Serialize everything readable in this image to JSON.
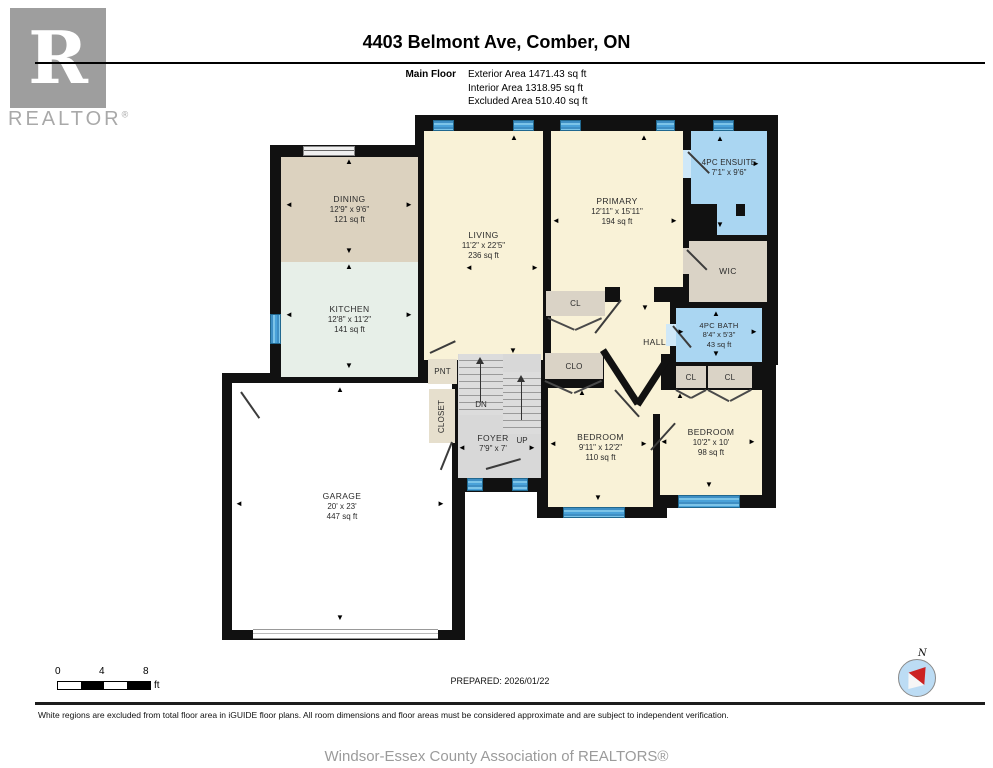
{
  "header": {
    "logo_text": "REALTOR",
    "logo_reg": "®",
    "logo_letter": "R",
    "title": "4403 Belmont Ave, Comber, ON",
    "floor_label": "Main Floor",
    "exterior_area": "Exterior Area 1471.43 sq ft",
    "interior_area": "Interior Area 1318.95 sq ft",
    "excluded_area": "Excluded Area 510.40 sq ft"
  },
  "plan": {
    "rooms": {
      "dining": {
        "name": "DINING",
        "dims": "12'9\" x 9'6\"",
        "area": "121 sq ft"
      },
      "kitchen": {
        "name": "KITCHEN",
        "dims": "12'8\" x 11'2\"",
        "area": "141 sq ft"
      },
      "living": {
        "name": "LIVING",
        "dims": "11'2\" x 22'5\"",
        "area": "236 sq ft"
      },
      "primary": {
        "name": "PRIMARY",
        "dims": "12'11\" x 15'11\"",
        "area": "194 sq ft"
      },
      "ensuite": {
        "name": "4PC ENSUITE",
        "dims": "7'1\" x 9'6\""
      },
      "wic": {
        "name": "WIC"
      },
      "bath": {
        "name": "4PC BATH",
        "dims": "8'4\" x 5'3\"",
        "area": "43 sq ft"
      },
      "hall": {
        "name": "HALL"
      },
      "bedroom1": {
        "name": "BEDROOM",
        "dims": "9'11\" x 12'2\"",
        "area": "110 sq ft"
      },
      "bedroom2": {
        "name": "BEDROOM",
        "dims": "10'2\" x 10'",
        "area": "98 sq ft"
      },
      "garage": {
        "name": "GARAGE",
        "dims": "20' x 23'",
        "area": "447 sq ft"
      },
      "foyer": {
        "name": "FOYER",
        "dims": "7'9\" x 7'"
      },
      "pnt": {
        "name": "PNT"
      },
      "closet": {
        "name": "CLOSET"
      },
      "clo": {
        "name": "CLO"
      },
      "cl": {
        "name": "CL"
      },
      "stairs": {
        "dn": "DN",
        "up": "UP"
      }
    }
  },
  "footer": {
    "scale": {
      "t0": "0",
      "t4": "4",
      "t8": "8",
      "unit": "ft"
    },
    "prepared": "PREPARED: 2026/01/22",
    "compass_n": "N",
    "disclaimer": "White regions are excluded from total floor area in iGUIDE floor plans. All room dimensions and floor areas must be considered approximate and are subject to independent verification.",
    "association": "Windsor-Essex County Association of REALTORS®"
  },
  "colors": {
    "wall": "#111111",
    "room_cream": "#f9f2d7",
    "dining_tan": "#dcd2bf",
    "kitchen_mint": "#e7efe8",
    "bath_blue": "#aad6f2",
    "closet_tan": "#dad3c6",
    "foyer_gray": "#d8d8d8",
    "window_blue": "#4aa2d9",
    "logo_gray": "#9e9e9e",
    "compass_blue": "#bcdcf4",
    "needle_red": "#cc2222"
  }
}
